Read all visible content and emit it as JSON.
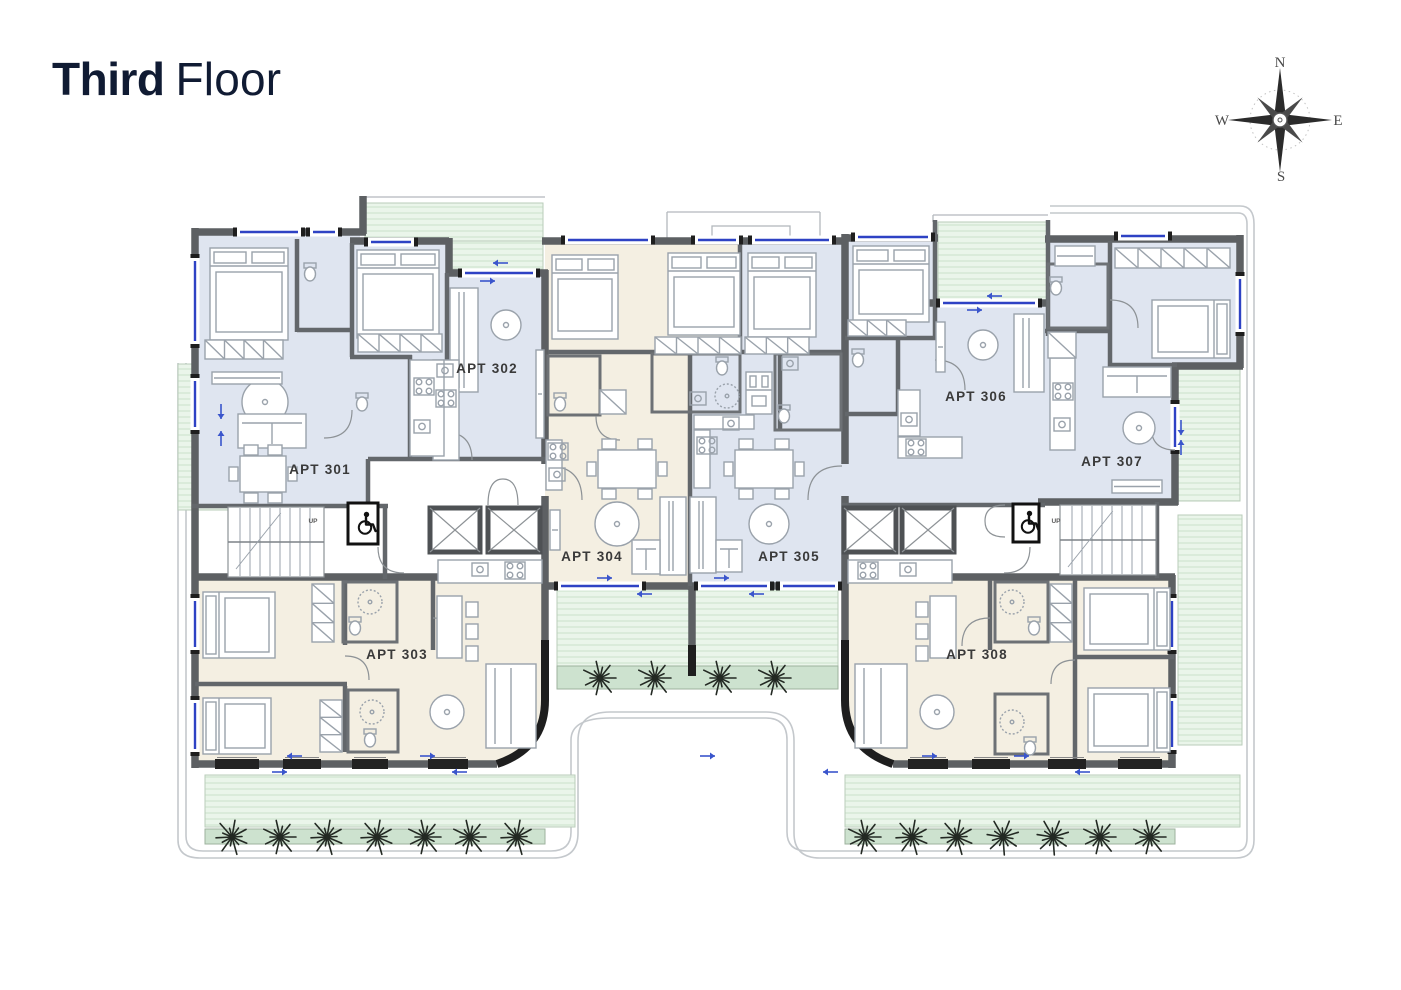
{
  "header": {
    "title_bold": "Third",
    "title_regular": "Floor",
    "title_color": "#101b33"
  },
  "compass": {
    "north": "N",
    "east": "E",
    "south": "S",
    "west": "W"
  },
  "floor_plan": {
    "colors": {
      "wall": "#5d6063",
      "wall_dark": "#1e1e1e",
      "room_blue": "#dfe5f0",
      "room_cream": "#f4efe2",
      "terrace_green": "#eaf5ea",
      "terrace_stripe": "#d6e9d7",
      "planter_green": "#cde2cf",
      "furniture_line": "#9aa2ab",
      "window_blue": "#2e42c4",
      "site_line": "#c4c8cc",
      "label_color": "#3a3a3a",
      "title-color": "#101b33"
    },
    "apartments": [
      {
        "id": "301",
        "label": "APT 301",
        "x": 320,
        "y": 474,
        "zone": "blue"
      },
      {
        "id": "302",
        "label": "APT 302",
        "x": 487,
        "y": 373,
        "zone": "blue"
      },
      {
        "id": "303",
        "label": "APT 303",
        "x": 397,
        "y": 659,
        "zone": "cream"
      },
      {
        "id": "304",
        "label": "APT 304",
        "x": 592,
        "y": 561,
        "zone": "cream"
      },
      {
        "id": "305",
        "label": "APT 305",
        "x": 789,
        "y": 561,
        "zone": "blue"
      },
      {
        "id": "306",
        "label": "APT 306",
        "x": 976,
        "y": 401,
        "zone": "blue"
      },
      {
        "id": "307",
        "label": "APT 307",
        "x": 1112,
        "y": 466,
        "zone": "blue"
      },
      {
        "id": "308",
        "label": "APT 308",
        "x": 977,
        "y": 659,
        "zone": "cream"
      }
    ],
    "stairs": {
      "up_label": "UP",
      "up_positions": [
        {
          "x": 313,
          "y": 523
        },
        {
          "x": 1056,
          "y": 523
        }
      ]
    },
    "accessible_wc_icon": "wheelchair-icon",
    "accessible_wcs": [
      {
        "x": 363,
        "y": 523
      },
      {
        "x": 1026,
        "y": 522
      }
    ]
  }
}
